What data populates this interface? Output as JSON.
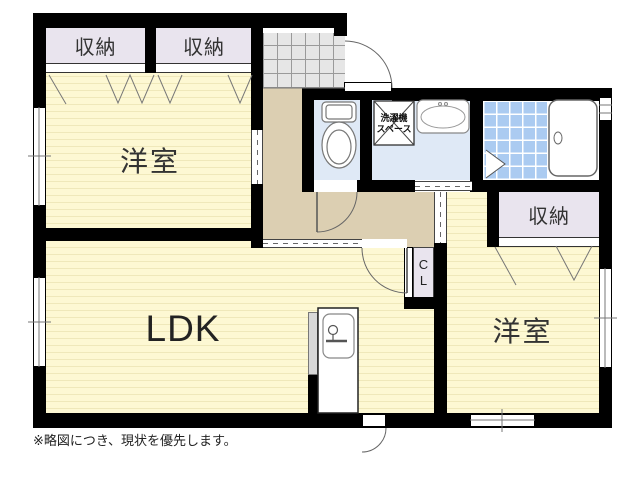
{
  "plan": {
    "rooms": {
      "bedroom1": {
        "label": "洋室"
      },
      "ldk": {
        "label": "LDK"
      },
      "bedroom2": {
        "label": "洋室"
      }
    },
    "closets": {
      "closet1": {
        "label": "収納"
      },
      "closet2": {
        "label": "収納"
      },
      "closet3": {
        "label": "収納"
      },
      "cl": {
        "line1": "C",
        "line2": "L"
      }
    },
    "fixtures": {
      "laundry": {
        "line1": "洗濯機",
        "line2": "スペース"
      }
    },
    "note": "※略図につき、現状を優先します。",
    "colors": {
      "wall": "#000000",
      "room_fill": "#fdf8d3",
      "room_stripe": "#efe8ba",
      "closet_fill": "#e9e4ee",
      "hallway_fill": "#dccfb2",
      "wet_area_fill": "#dfe9f6",
      "bath_tile": "#abcbf1",
      "entrance_tile": "#e6e6e6"
    }
  }
}
